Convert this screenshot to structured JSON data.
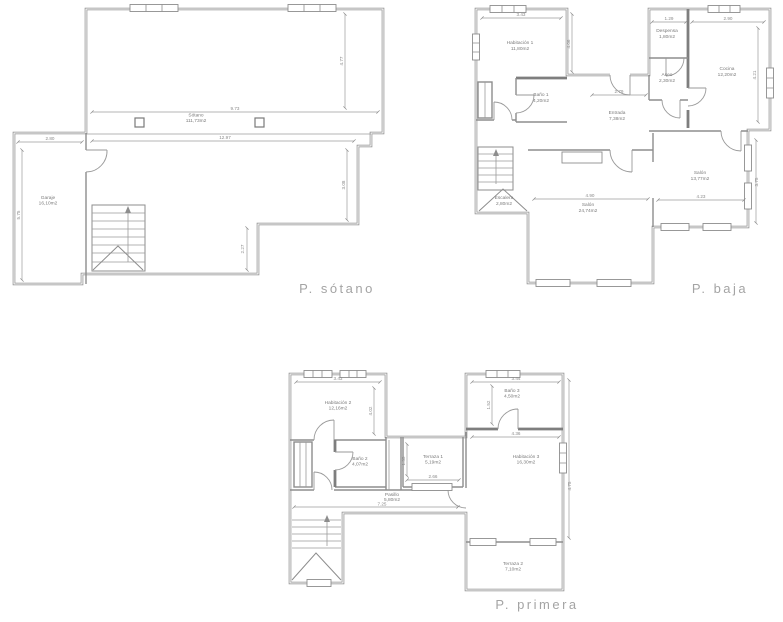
{
  "canvas": {
    "background": "#ffffff",
    "line_color": "#8d8d8d",
    "text_color": "#7b7b7b",
    "title_color": "#a4a4a4"
  },
  "plans": {
    "sotano": {
      "title": "P. sótano",
      "rooms": {
        "main": {
          "name": "Sótano",
          "area": "111,73m2"
        },
        "garaje": {
          "name": "Garaje",
          "area": "16,10m2"
        }
      },
      "dims": {
        "top_width": "9.73",
        "full_width": "12.97",
        "right_height": "4.77",
        "garage_width": "2.80",
        "garage_height": "5.75",
        "lower_right_height": "3.08",
        "step_height": "2.27"
      }
    },
    "baja": {
      "title": "P. baja",
      "rooms": {
        "habitacion1": {
          "name": "Habitación 1",
          "area": "11,80m2"
        },
        "bano1": {
          "name": "Baño 1",
          "area": "4,20m2"
        },
        "despensa": {
          "name": "Despensa",
          "area": "1,80m2"
        },
        "aseo": {
          "name": "Aseo",
          "area": "2,30m2"
        },
        "cocina": {
          "name": "Cocina",
          "area": "12,20m2"
        },
        "entrada": {
          "name": "Entrada",
          "area": "7,38m2"
        },
        "salon1": {
          "name": "Salón",
          "area": "13,77m2"
        },
        "salon2": {
          "name": "Salón",
          "area": "24,74m2"
        },
        "escalera": {
          "name": "Escalera",
          "area": "2,80m2"
        }
      },
      "dims": {
        "hab1_width": "3.43",
        "hab1_height": "4.06",
        "despensa_width": "1.29",
        "cocina_width": "2.90",
        "cocina_height": "4.21",
        "entrada_width": "2.79",
        "salon1_width": "4.23",
        "salon1_height": "3.75",
        "salon2_width": "4.90"
      }
    },
    "primera": {
      "title": "P. primera",
      "rooms": {
        "habitacion2": {
          "name": "Habitación 2",
          "area": "12,16m2"
        },
        "bano2": {
          "name": "Baño 2",
          "area": "4,07m2"
        },
        "terraza1": {
          "name": "Terraza 1",
          "area": "5,19m2"
        },
        "bano3": {
          "name": "Baño 3",
          "area": "4,50m2"
        },
        "habitacion3": {
          "name": "Habitación 3",
          "area": "16,30m2"
        },
        "terraza2": {
          "name": "Terraza 2",
          "area": "7,10m2"
        },
        "pasillo": {
          "name": "Pasillo",
          "area": "5,80m2"
        }
      },
      "dims": {
        "hab2_width": "3.43",
        "hab2_height": "4.02",
        "terraza1_width": "2.66",
        "terraza1_height": "1.35",
        "bano3_width": "3.44",
        "bano3_height": "1.52",
        "hab3_width": "4.36",
        "right_height": "4.75",
        "pasillo_length": "7.25"
      }
    }
  }
}
